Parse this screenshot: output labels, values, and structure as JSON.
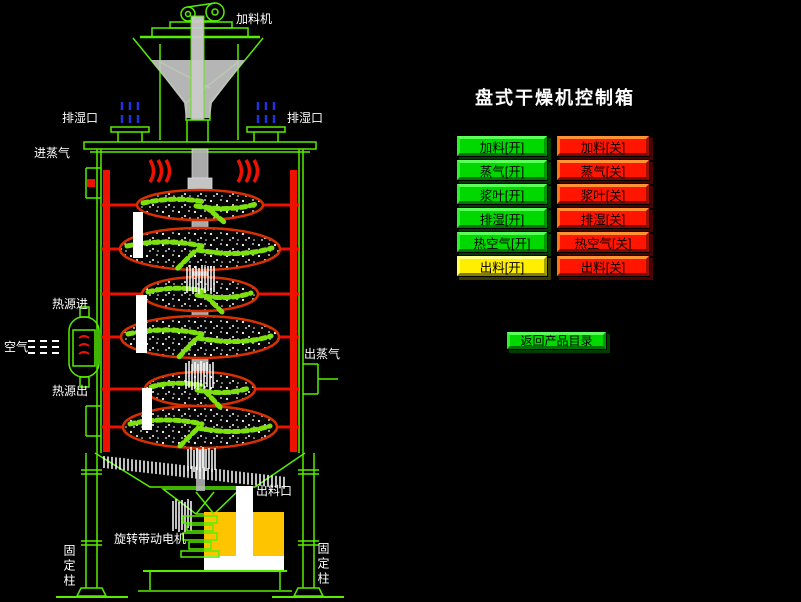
{
  "title": "盘式干燥机控制箱",
  "controls": {
    "rows": [
      {
        "on": "加料[开]",
        "off": "加料[关]"
      },
      {
        "on": "蒸气[开]",
        "off": "蒸气[关]"
      },
      {
        "on": "浆叶[开]",
        "off": "浆叶[关]"
      },
      {
        "on": "排湿[开]",
        "off": "排湿[关]"
      },
      {
        "on": "热空气[开]",
        "off": "热空气[关]"
      },
      {
        "on": "出料[开]",
        "off": "出料[关]"
      }
    ],
    "back_label": "返回产品目录"
  },
  "diagram": {
    "labels": {
      "feeder": "加料机",
      "vent_left": "排湿口",
      "vent_right": "排湿口",
      "steam_in": "进蒸气",
      "heat_in": "热源进",
      "air": "空气",
      "heat_out": "热源出",
      "steam_out": "出蒸气",
      "discharge": "出料口",
      "drive_motor": "旋转带动电机",
      "column_left": "固定柱",
      "column_right": "固定柱"
    }
  },
  "colors": {
    "background": "#000000",
    "line_green": "#55ee00",
    "pipe_red": "#ee1100",
    "disc_rim": "#d83000",
    "rake_green": "#7fe010",
    "arrow_blue": "#2233dd",
    "motor_yellow": "#ffc400",
    "button_on_green": "#00d800",
    "button_off_red": "#ff1500",
    "button_discharge_yellow": "#ffee00",
    "label_white": "#ffffff"
  }
}
